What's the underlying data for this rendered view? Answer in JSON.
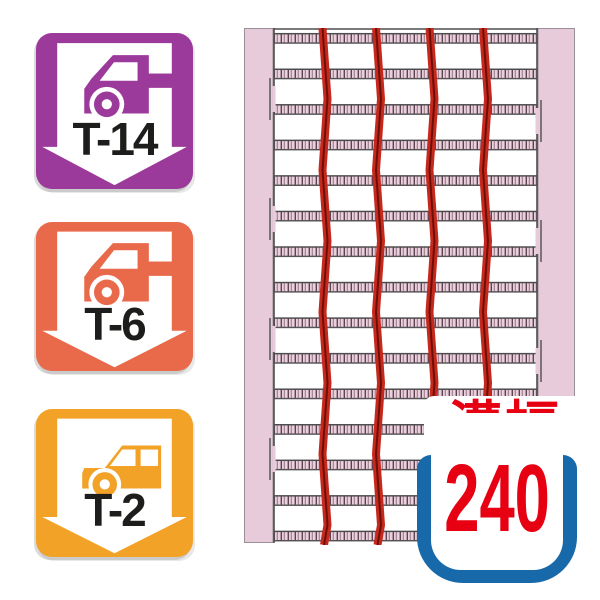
{
  "badges": [
    {
      "id": "t14",
      "label": "T-14",
      "vehicle_icon": "truck-icon",
      "color": "#9C3A9C"
    },
    {
      "id": "t6",
      "label": "T-6",
      "vehicle_icon": "truck-icon",
      "color": "#E96A4B"
    },
    {
      "id": "t2",
      "label": "T-2",
      "vehicle_icon": "car-icon",
      "color": "#F2A227"
    }
  ],
  "grating": {
    "description": "top view of steel grating in U-channel",
    "frame_color": "#E8CBDB",
    "cross_bar_rows": 15,
    "bearing_bars": 4,
    "bearing_bar_color": "#C5281C"
  },
  "groove_width_marker": {
    "label": "溝幅",
    "value": "240",
    "text_color": "#E60012",
    "channel_color": "#1769A9",
    "channel_icon": "u-channel-icon"
  }
}
